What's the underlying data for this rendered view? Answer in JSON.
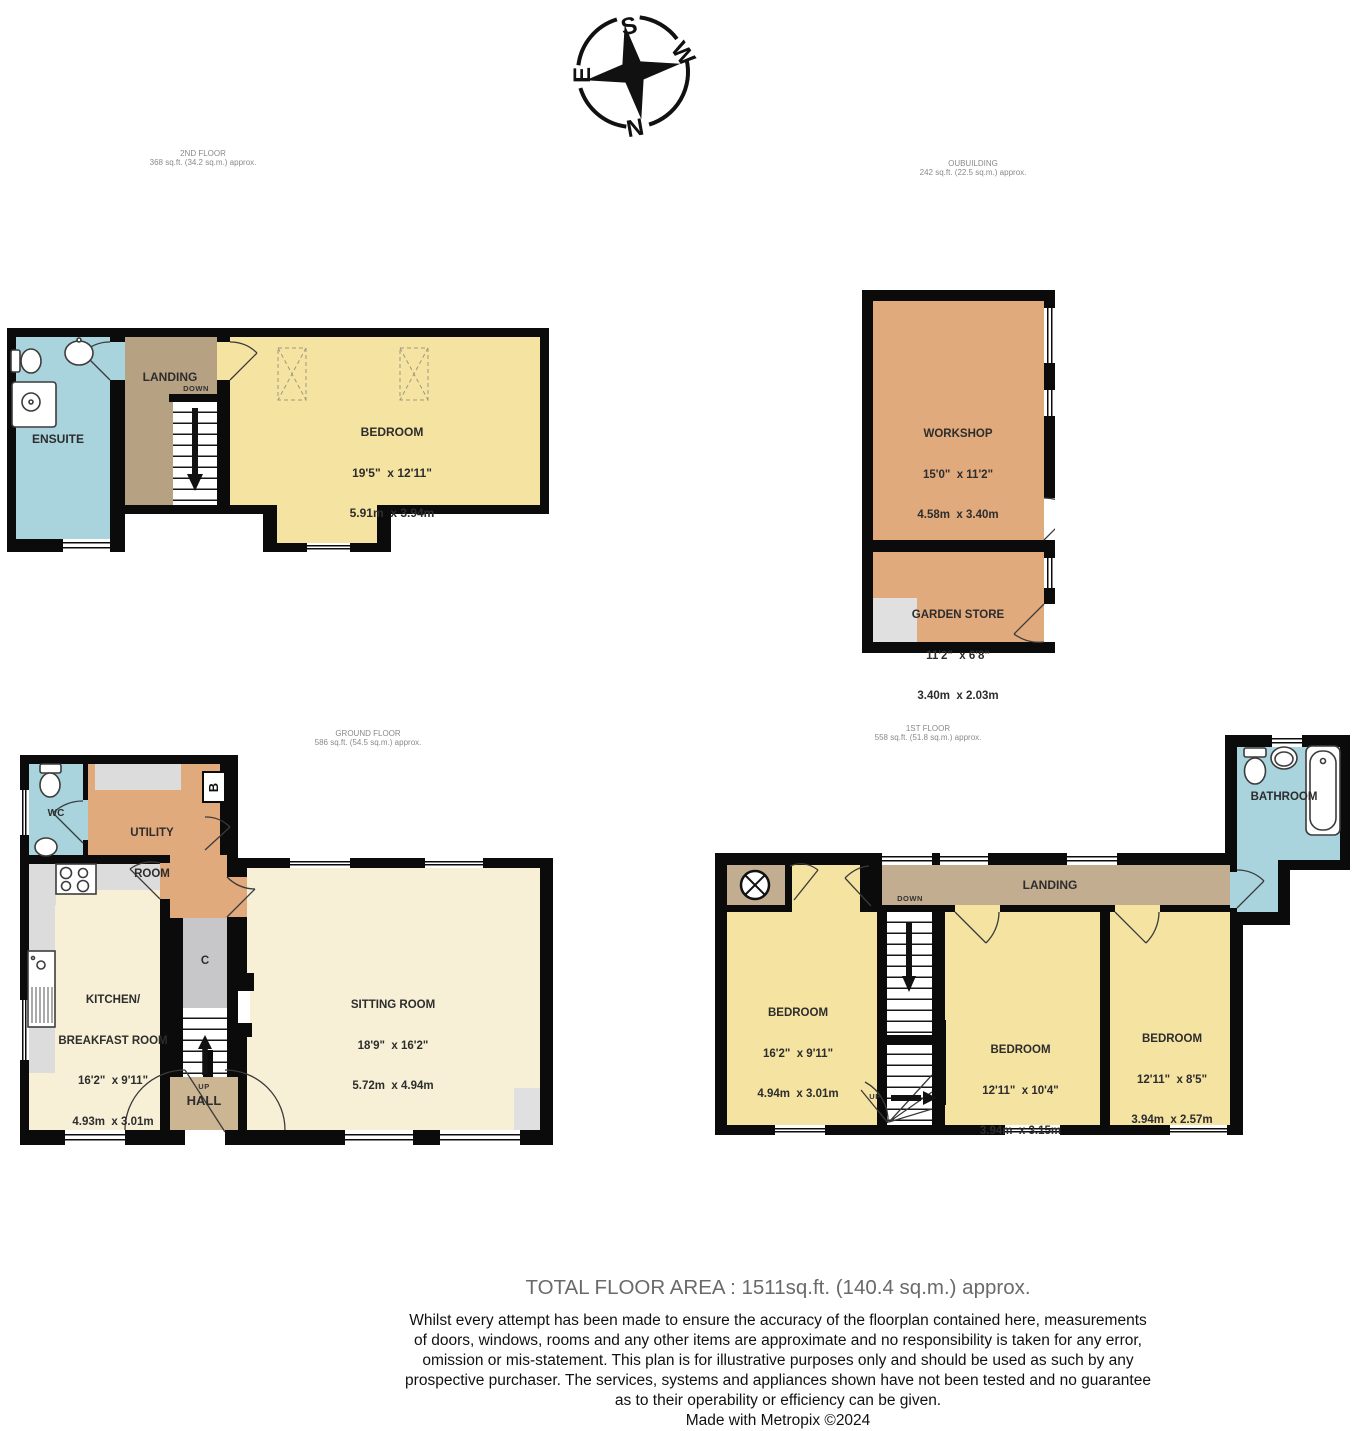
{
  "compass": {
    "north": "N",
    "south": "S",
    "east": "E",
    "west": "W"
  },
  "floors": {
    "second": {
      "title": "2ND FLOOR",
      "area": "368 sq.ft. (34.2 sq.m.) approx.",
      "ensuite": "ENSUITE",
      "landing": "LANDING",
      "down": "DOWN",
      "bedroom": {
        "name": "BEDROOM",
        "imperial": "19'5\"  x 12'11\"",
        "metric": "5.91m  x 3.94m"
      }
    },
    "outbuilding": {
      "title": "OUBUILDING",
      "area": "242 sq.ft. (22.5 sq.m.) approx.",
      "workshop": {
        "name": "WORKSHOP",
        "imperial": "15'0\"  x 11'2\"",
        "metric": "4.58m  x 3.40m"
      },
      "garden_store": {
        "name": "GARDEN STORE",
        "imperial": "11'2\"  x 6'8\"",
        "metric": "3.40m  x 2.03m"
      }
    },
    "ground": {
      "title": "GROUND FLOOR",
      "area": "586 sq.ft. (54.5 sq.m.) approx.",
      "wc": "WC",
      "utility": {
        "line1": "UTILITY",
        "line2": "ROOM"
      },
      "boiler": "B",
      "kitchen": {
        "name1": "KITCHEN/",
        "name2": "BREAKFAST ROOM",
        "imperial": "16'2\"  x 9'11\"",
        "metric": "4.93m  x 3.01m"
      },
      "cupboard": "C",
      "hall": {
        "up": "UP",
        "name": "HALL"
      },
      "sitting": {
        "name": "SITTING ROOM",
        "imperial": "18'9\"  x 16'2\"",
        "metric": "5.72m  x 4.94m"
      }
    },
    "first": {
      "title": "1ST FLOOR",
      "area": "558 sq.ft. (51.8 sq.m.) approx.",
      "bathroom": "BATHROOM",
      "landing": "LANDING",
      "down": "DOWN",
      "up": "UP",
      "bedroom1": {
        "name": "BEDROOM",
        "imperial": "16'2\"  x 9'11\"",
        "metric": "4.94m  x 3.01m"
      },
      "bedroom2": {
        "name": "BEDROOM",
        "imperial": "12'11\"  x 10'4\"",
        "metric": "3.94m  x 3.15m"
      },
      "bedroom3": {
        "name": "BEDROOM",
        "imperial": "12'11\"  x 8'5\"",
        "metric": "3.94m  x 2.57m"
      }
    }
  },
  "footer": {
    "total": "TOTAL FLOOR AREA : 1511sq.ft. (140.4 sq.m.) approx.",
    "disclaimer": [
      "Whilst every attempt has been made to ensure the accuracy of the floorplan contained here, measurements",
      "of doors, windows, rooms and any other items are approximate and no responsibility is taken for any error,",
      "omission or mis-statement. This plan is for illustrative purposes only and should be used as such by any",
      "prospective purchaser. The services, systems and appliances shown have not been tested and no guarantee",
      "as to their operability or efficiency can be given."
    ],
    "credit": "Made with Metropix ©2024"
  },
  "palette": {
    "wall": "#0b0b0b",
    "wet_room_blue": "#a9d4de",
    "bedroom_yellow": "#f5e3a2",
    "living_cream": "#f7f0d6",
    "outbuilding_orange": "#e1aa7d",
    "first_landing_tan": "#c3ad90",
    "second_landing_tan": "#b7a183",
    "hall_tan": "#ccb593",
    "cupboard_gray": "#c7c7c9"
  }
}
